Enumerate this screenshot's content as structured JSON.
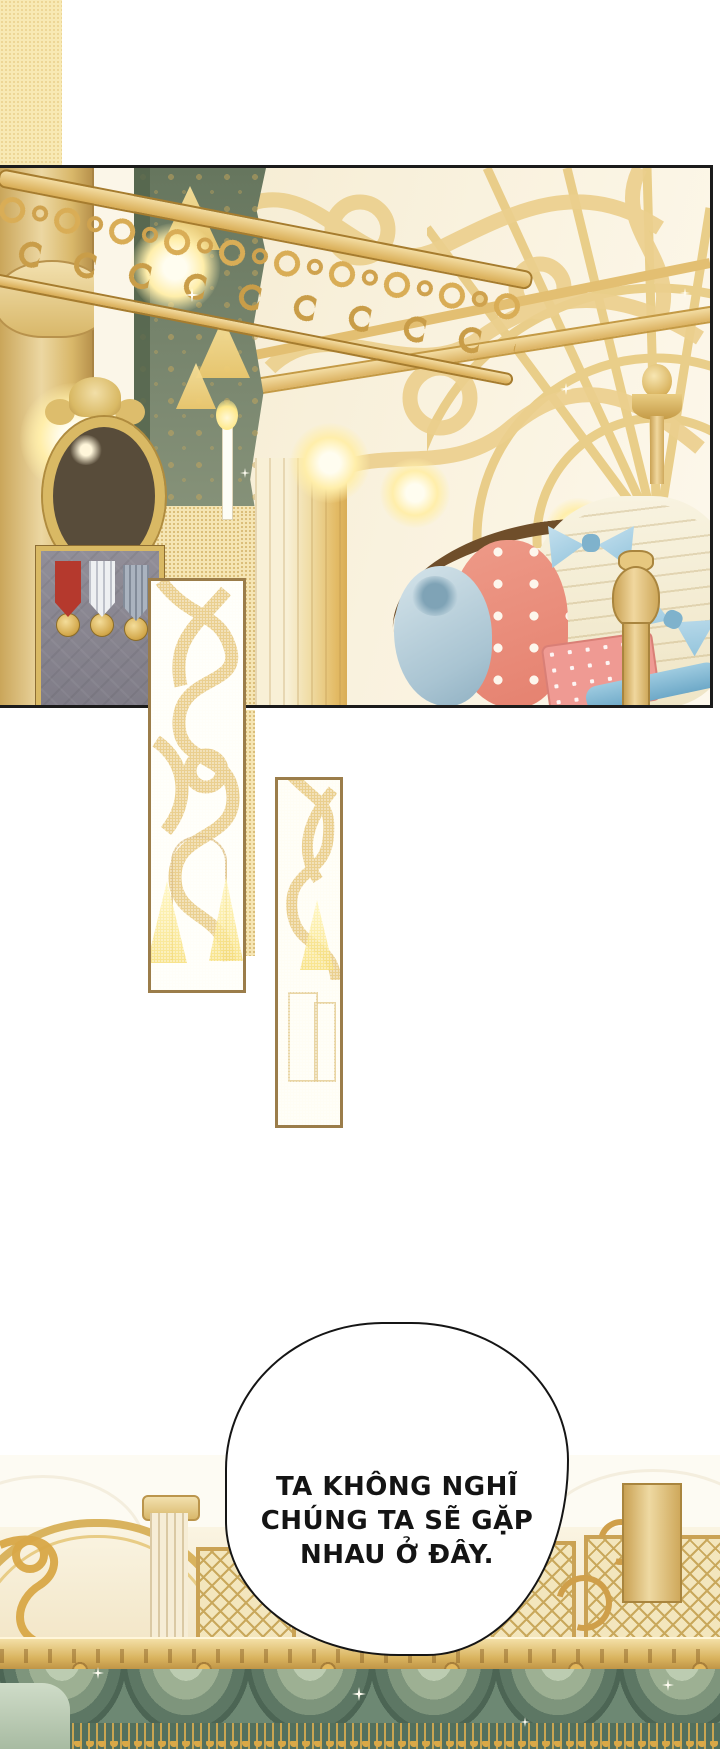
{
  "page": {
    "width": 720,
    "height": 1749,
    "background": "#ffffff",
    "type": "manhwa-comic-page"
  },
  "speech_bubble": {
    "lines": [
      "TA KHÔNG NGHĨ",
      "CHÚNG TA SẼ GẶP",
      "NHAU Ở ĐÂY."
    ],
    "text_color": "#141414",
    "fill": "#ffffff",
    "border_color": "#151515"
  },
  "regions": {
    "top_panel": "gilded palace room with green damask curtain, ornate mirror, medal display case, gold filigree screen, descending gold railing, gowns with blue bows and a pink gift box",
    "decor_strip_left": "tall bordered strip of white-and-gold filigree with candle glow",
    "decor_strip_right": "bordered strip of gold filigree over faint door sketch",
    "decor_strip_yellow": "plain pale-gold halftone strip",
    "bottom_scene": "ballroom wall with columns, gold lattice panels, cornice and green swag valance with gold fringe"
  },
  "palette": {
    "panel_border": "#1b1b1b",
    "gold": "#d9b35e",
    "gold_light": "#f0dca4",
    "gold_deep": "#c49a45",
    "cream": "#f7eed8",
    "curtain_green": "#7d8a72",
    "curtain_green_dark": "#55654c",
    "valance_green": "#7e957c",
    "valance_green_dark": "#4c6554",
    "case_gray": "#8e8b94",
    "medal_red": "#b5392d",
    "medal_white": "#eef0f2",
    "medal_slate": "#aab3bf",
    "dress_blue": "#c2dbe7",
    "dress_coral": "#e98d7b",
    "dress_cream": "#f3ecd6",
    "bow_blue": "#a8d2e5",
    "gift_pink": "#ef9a93",
    "strip_border": "#9b7d4a"
  }
}
